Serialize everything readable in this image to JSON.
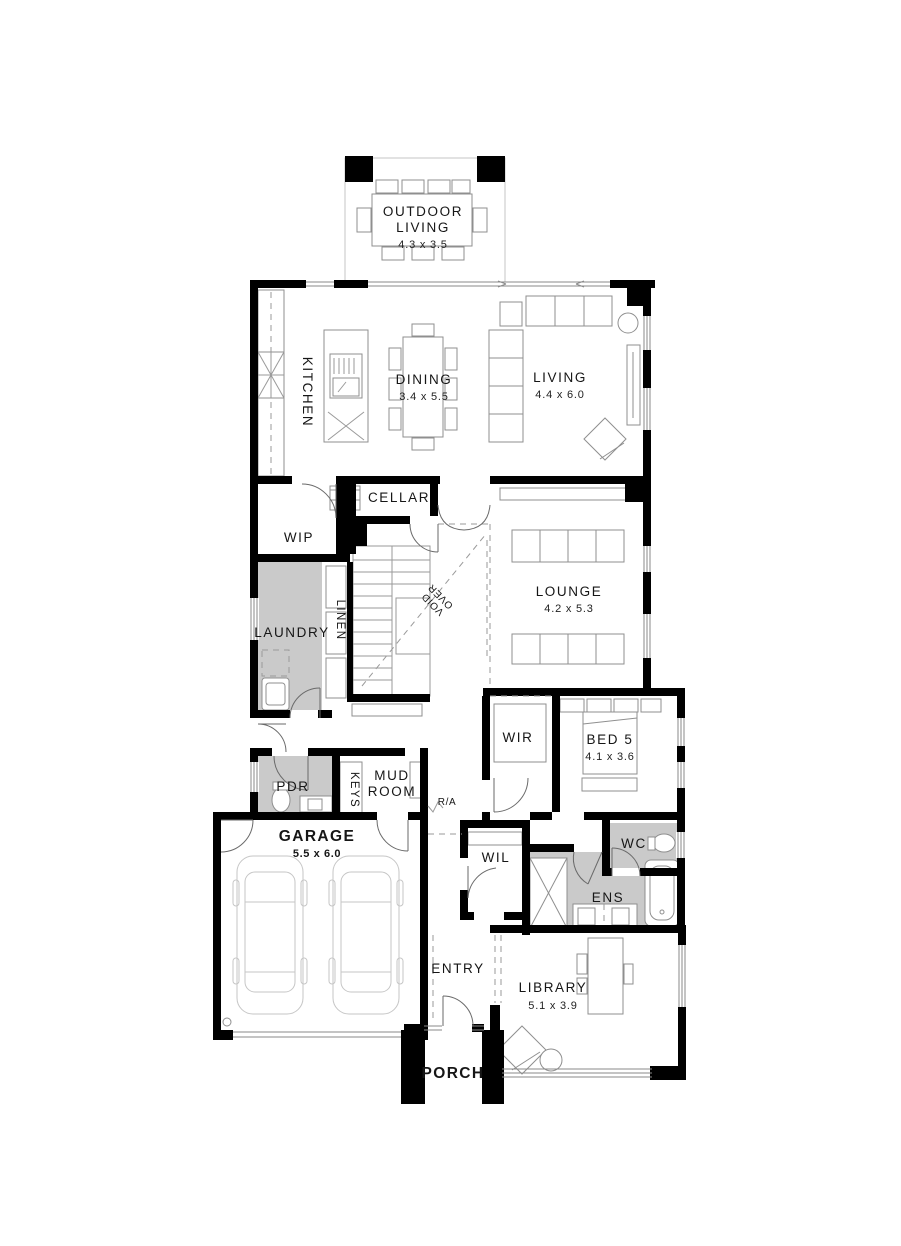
{
  "document": {
    "type": "house-floor-plan",
    "floor": "ground-floor"
  },
  "colors": {
    "wall": "#000000",
    "wet_area_fill": "#cacaca",
    "furniture_line": "#8f8f8f",
    "background": "#ffffff"
  },
  "rooms": {
    "outdoor_living": {
      "line1": "OUTDOOR",
      "line2": "LIVING",
      "dim": "4.3 x 3.5"
    },
    "kitchen": {
      "name": "KITCHEN"
    },
    "dining": {
      "name": "DINING",
      "dim": "3.4 x 5.5"
    },
    "living": {
      "name": "LIVING",
      "dim": "4.4 x 6.0"
    },
    "cellar": {
      "name": "CELLAR"
    },
    "wip": {
      "name": "WIP"
    },
    "laundry": {
      "name": "LAUNDRY"
    },
    "linen": {
      "name": "LINEN"
    },
    "void": {
      "line1": "VOID",
      "line2": "OVER"
    },
    "lounge": {
      "name": "LOUNGE",
      "dim": "4.2 x 5.3"
    },
    "wir": {
      "name": "WIR"
    },
    "bed5": {
      "name": "BED 5",
      "dim": "4.1 x 3.6"
    },
    "pdr": {
      "name": "PDR"
    },
    "keys": {
      "name": "KEYS"
    },
    "mud_room": {
      "line1": "MUD",
      "line2": "ROOM"
    },
    "ra": {
      "name": "R/A"
    },
    "garage": {
      "name": "GARAGE",
      "dim": "5.5 x 6.0"
    },
    "wil": {
      "name": "WIL"
    },
    "wc": {
      "name": "WC"
    },
    "ens": {
      "name": "ENS"
    },
    "entry": {
      "name": "ENTRY"
    },
    "library": {
      "name": "LIBRARY",
      "dim": "5.1 x 3.9"
    },
    "porch": {
      "name": "PORCH"
    }
  }
}
